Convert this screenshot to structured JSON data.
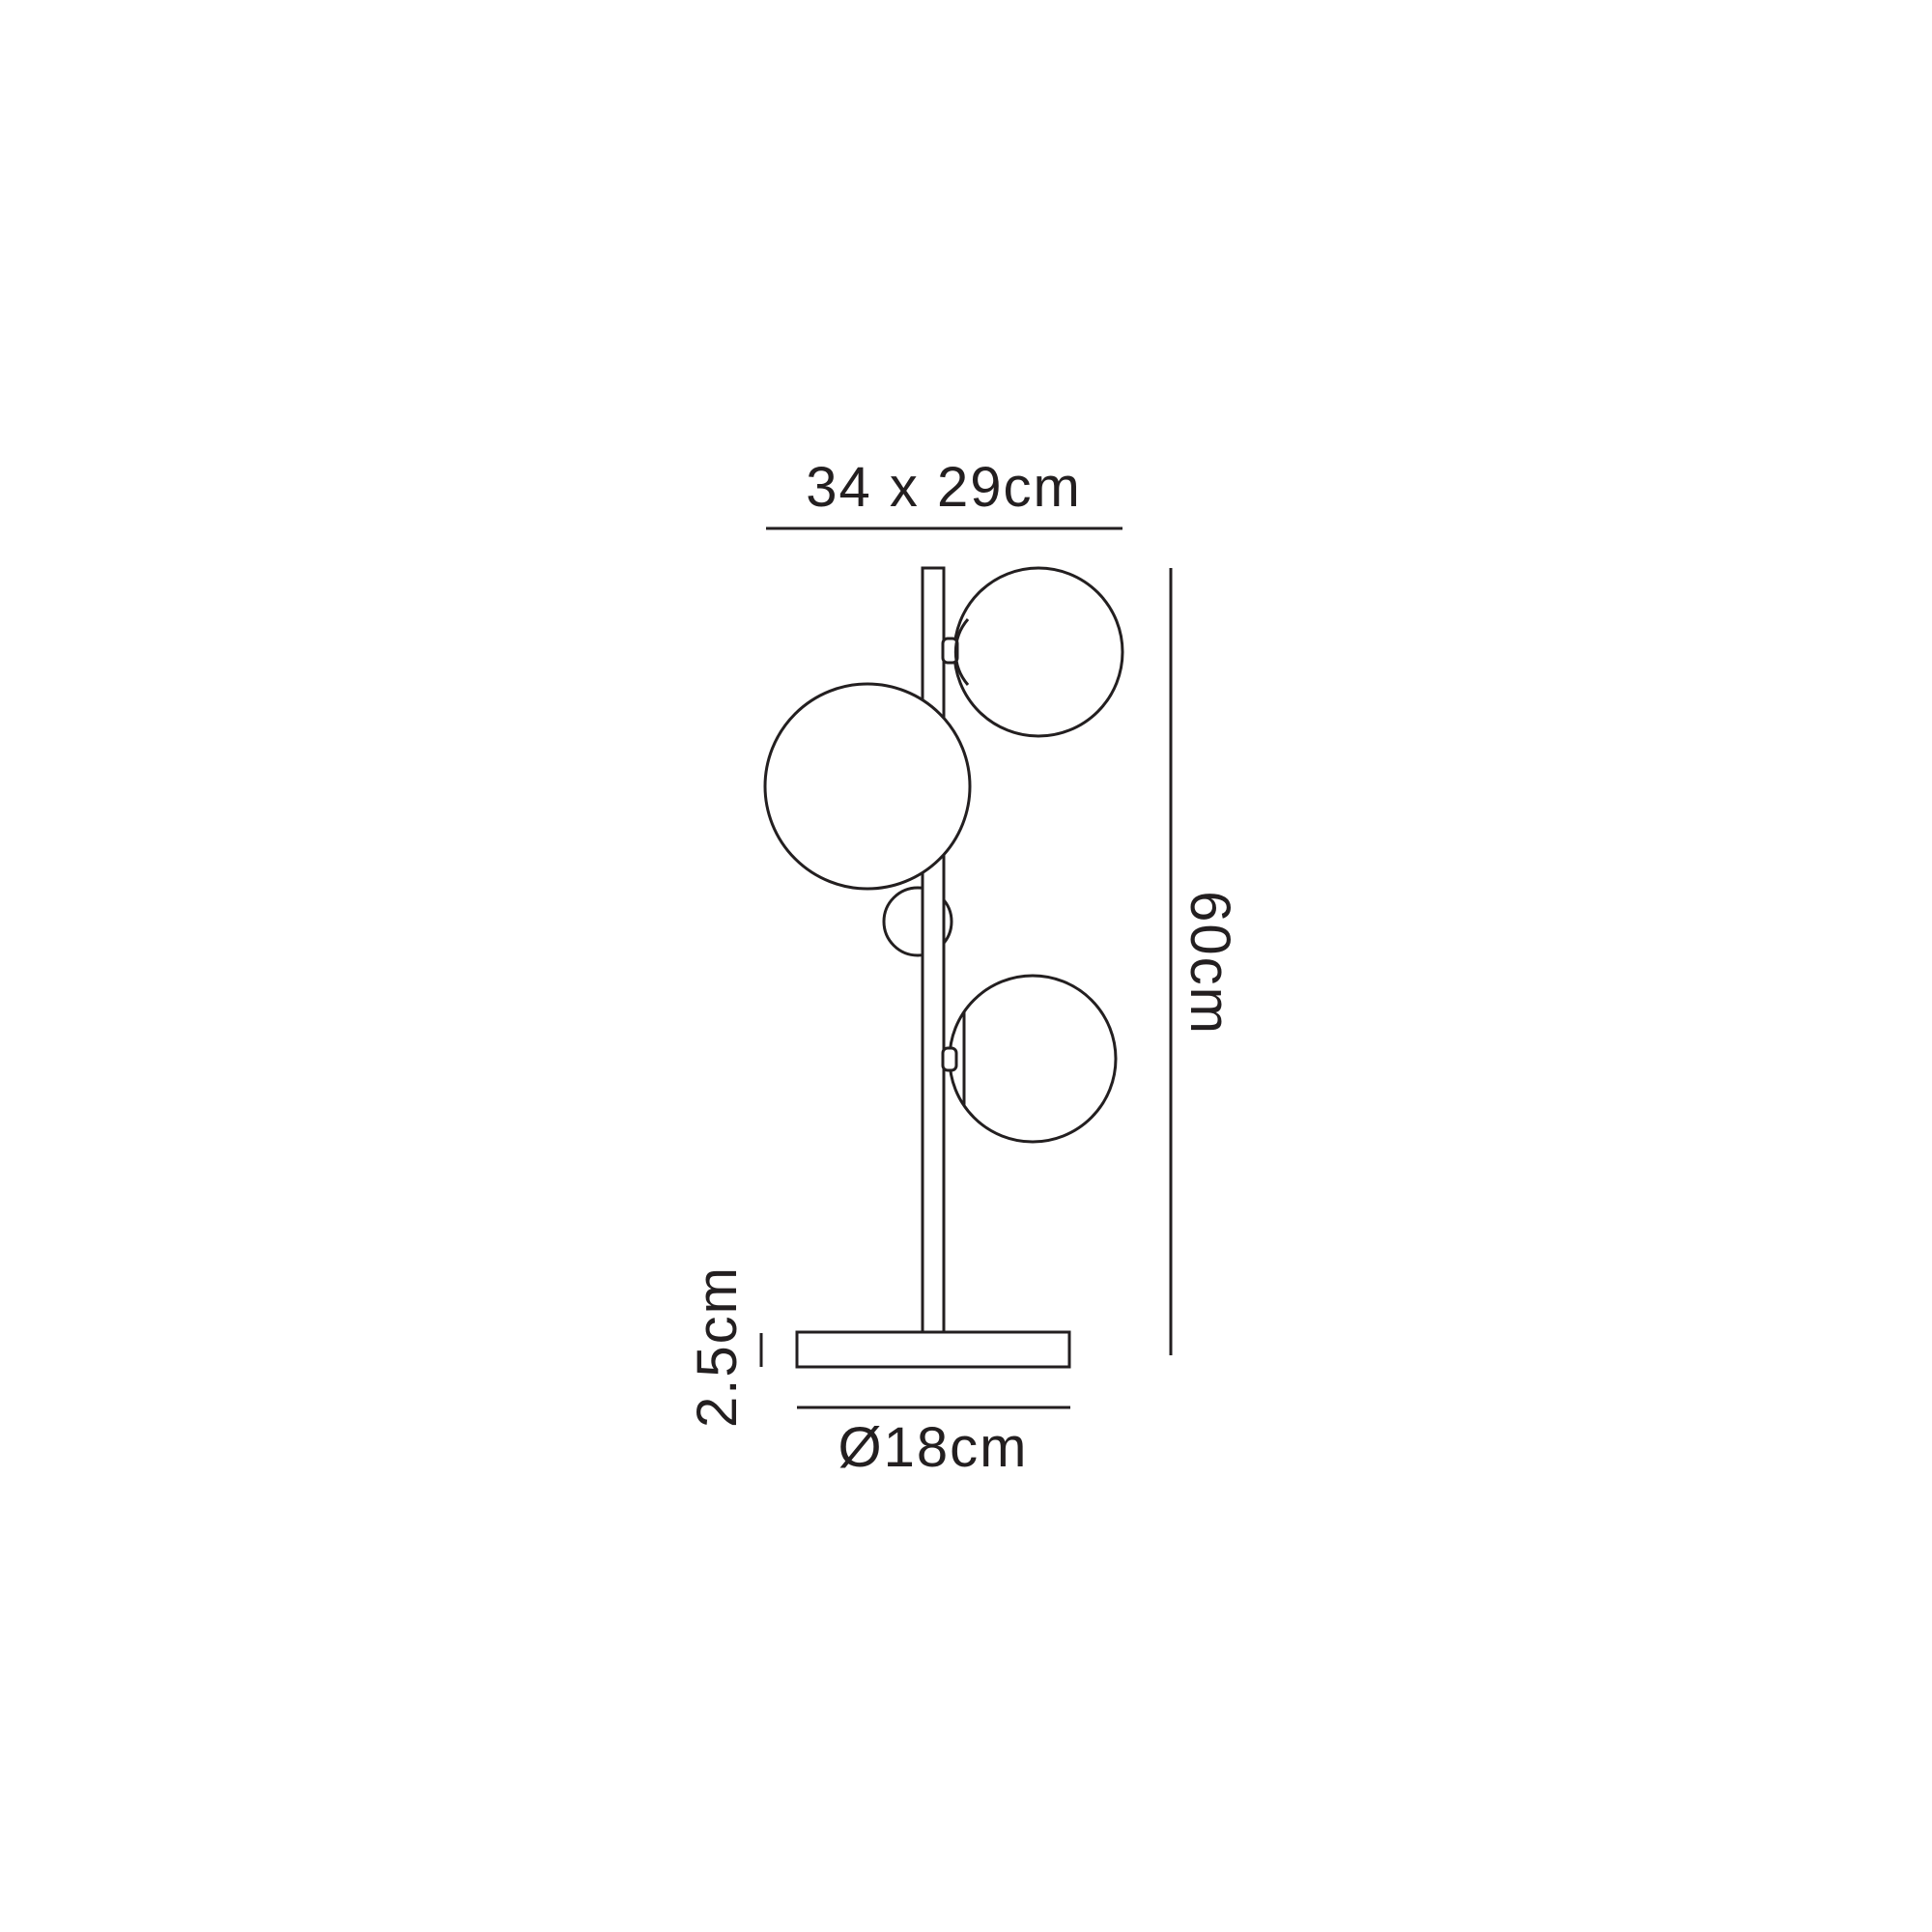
{
  "diagram": {
    "kind": "product-dimension-drawing",
    "labels": {
      "fixture_size": "34 x 29cm",
      "height": "60cm",
      "base_height": "2.5cm",
      "base_diameter": "Ø18cm"
    },
    "dimensions": {
      "fixture_width_cm": 34,
      "fixture_depth_cm": 29,
      "height_cm": 60,
      "base_height_cm": 2.5,
      "base_diameter_cm": 18
    },
    "colors": {
      "line": "#231f20",
      "background": "#ffffff"
    }
  }
}
